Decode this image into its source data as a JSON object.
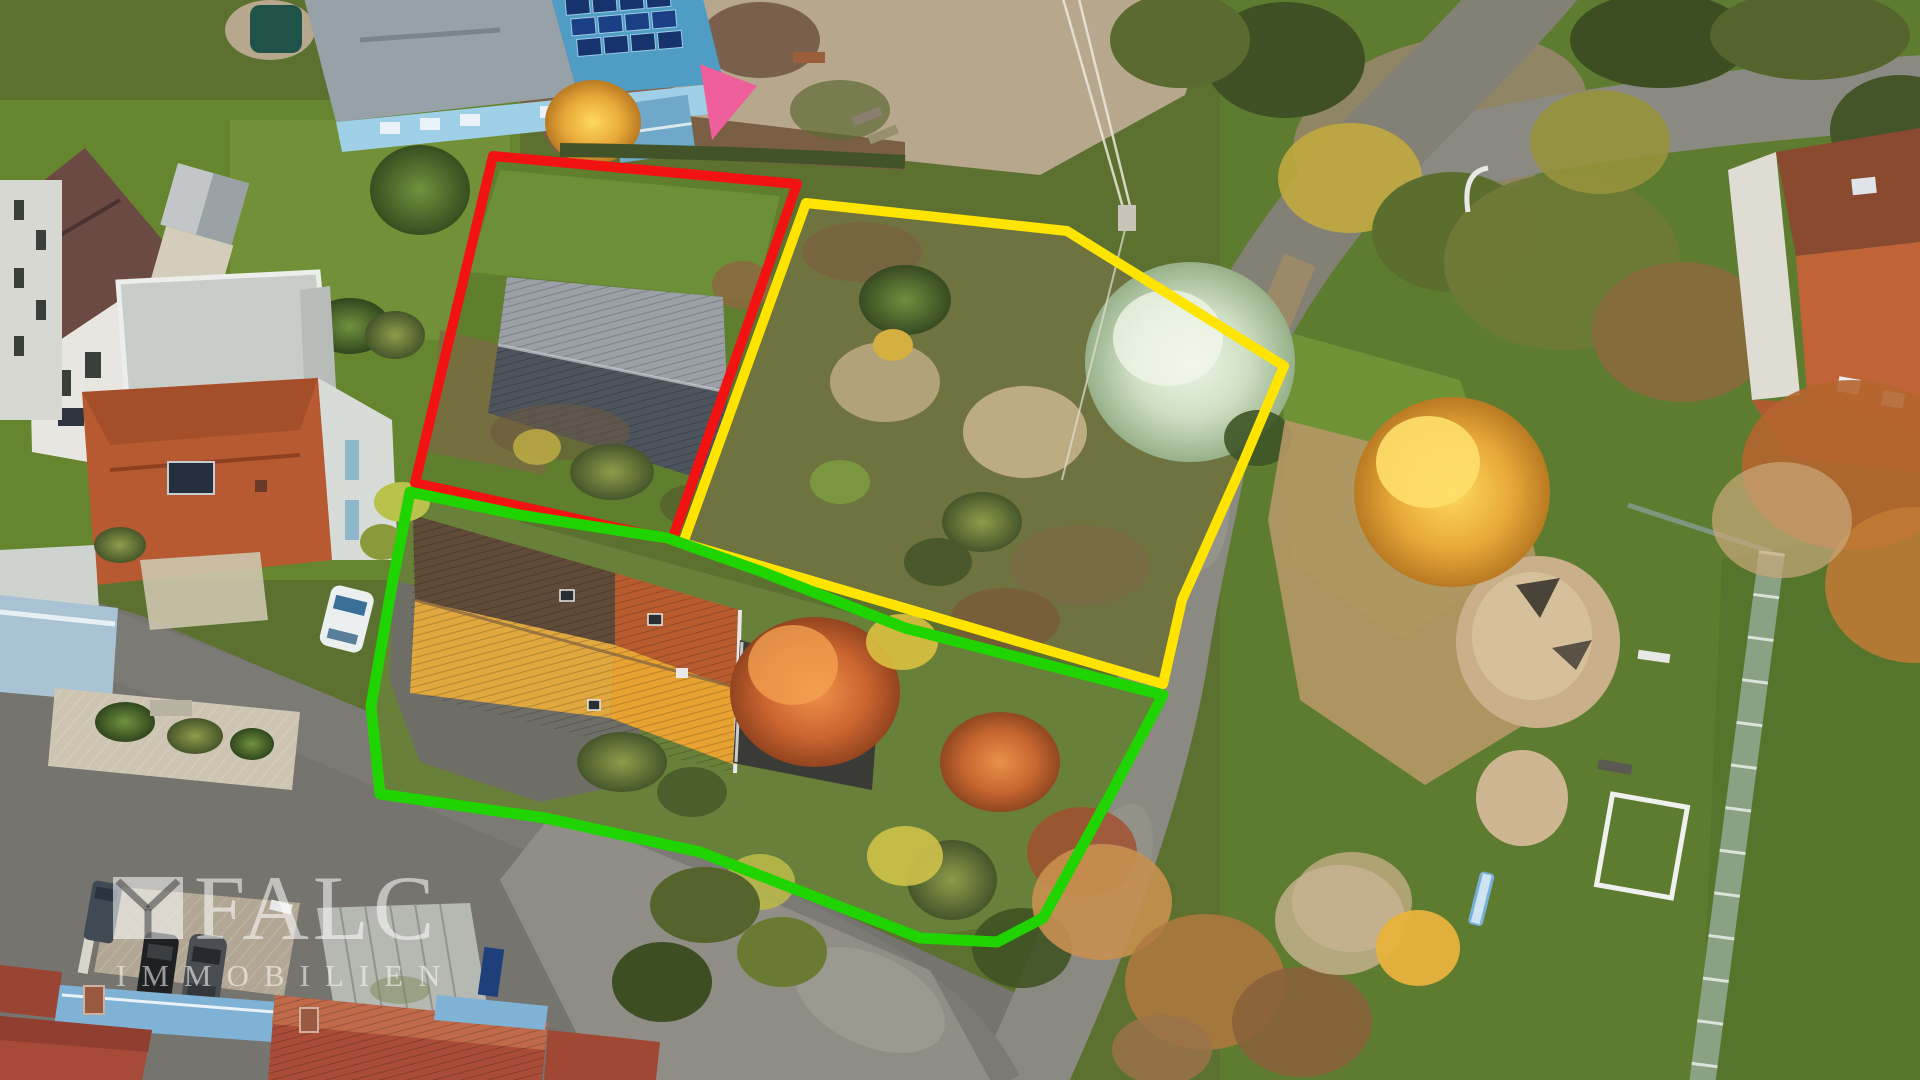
{
  "image": {
    "kind": "aerial-drone-photo",
    "width": 1920,
    "height": 1080
  },
  "watermark": {
    "brand": "FALC",
    "subtitle": "IMMOBILIEN",
    "color": "rgba(255,255,255,0.55)"
  },
  "plot_outlines": {
    "red": {
      "label": "plot-outline-red",
      "color": "#f21212",
      "points": "493,156 797,184 672,540 415,483"
    },
    "yellow": {
      "label": "plot-outline-yellow",
      "color": "#ffe400",
      "points": "806,203 1067,231 1284,366 1240,470 1182,600 1163,684 683,543"
    },
    "green": {
      "label": "plot-outline-green",
      "color": "#1fd400",
      "points": "410,492 520,515 667,538 760,571 905,628 1163,695 1113,790 1043,918 997,942 920,938 700,852 545,818 380,794 371,706 392,585"
    }
  },
  "features": [
    "old-barn-in-red-plot",
    "meadow-with-silver-tree-in-yellow-plot",
    "orange-roof-house-in-green-plot",
    "kindergarten-with-solar-roof",
    "playground-with-sandpit-and-slide",
    "falc-immobilien-watermark"
  ]
}
